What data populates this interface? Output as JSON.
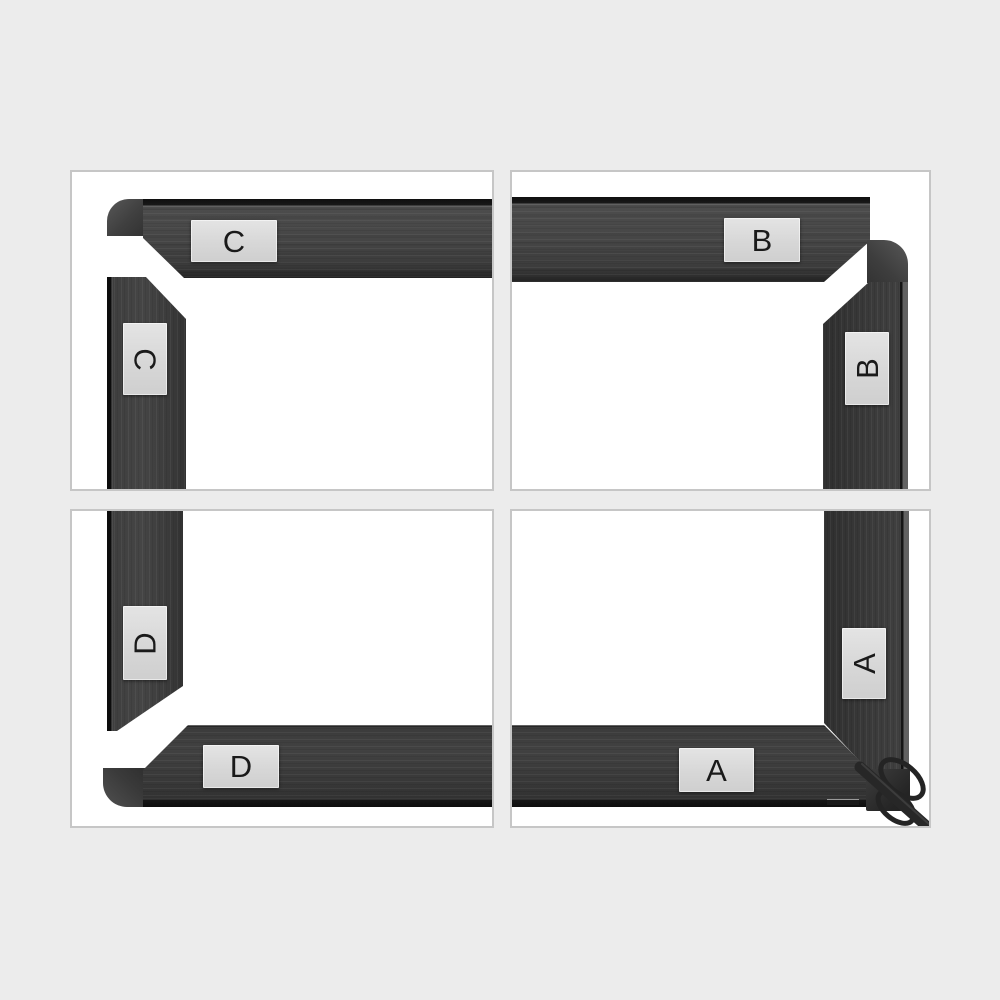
{
  "colors": {
    "page_bg": "#ececec",
    "panel_bg": "#ffffff",
    "panel_border": "#c6c6c6",
    "metal_body": "#424242",
    "metal_edge": "#141414",
    "label_bg": "#d9d9d9",
    "label_text": "#1a1a1a"
  },
  "panels": [
    {
      "position": "top-left",
      "letter": "C"
    },
    {
      "position": "top-right",
      "letter": "B"
    },
    {
      "position": "bottom-left",
      "letter": "D"
    },
    {
      "position": "bottom-right",
      "letter": "A"
    }
  ]
}
